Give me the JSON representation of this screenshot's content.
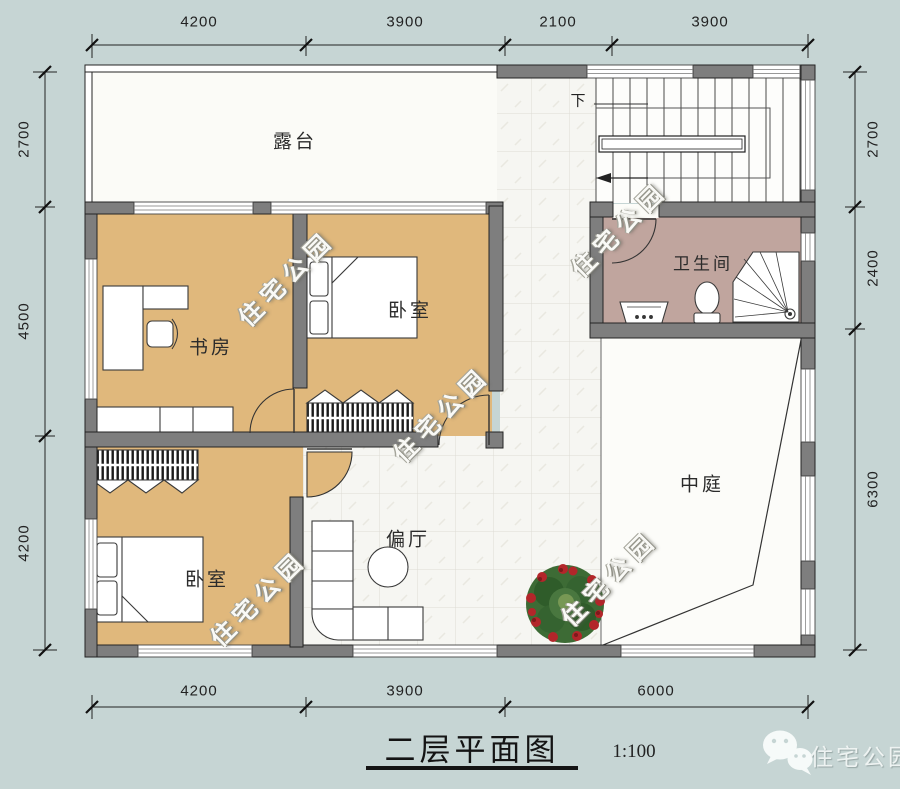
{
  "title": {
    "text": "二层平面图",
    "scale": "1:100"
  },
  "brand": {
    "name": "住宅公园"
  },
  "watermark": {
    "text": "住宅公园"
  },
  "rooms": {
    "terrace": "露台",
    "study": "书房",
    "bedroom_middle": "卧室",
    "bathroom": "卫生间",
    "atrium": "中庭",
    "side_hall": "偏厅",
    "bedroom_lower": "卧室"
  },
  "stairs": {
    "down": "下"
  },
  "dimensions": {
    "top": [
      "4200",
      "3900",
      "2100",
      "3900"
    ],
    "bottom": [
      "4200",
      "3900",
      "6000"
    ],
    "left": [
      "2700",
      "4500",
      "4200"
    ],
    "right": [
      "2700",
      "2400",
      "6300"
    ]
  },
  "colors": {
    "background": "#c6d5d4",
    "room_tan": "#e0b87c",
    "bathroom_mauve": "#c0a59e",
    "wall_gray": "#7e7e7e"
  }
}
